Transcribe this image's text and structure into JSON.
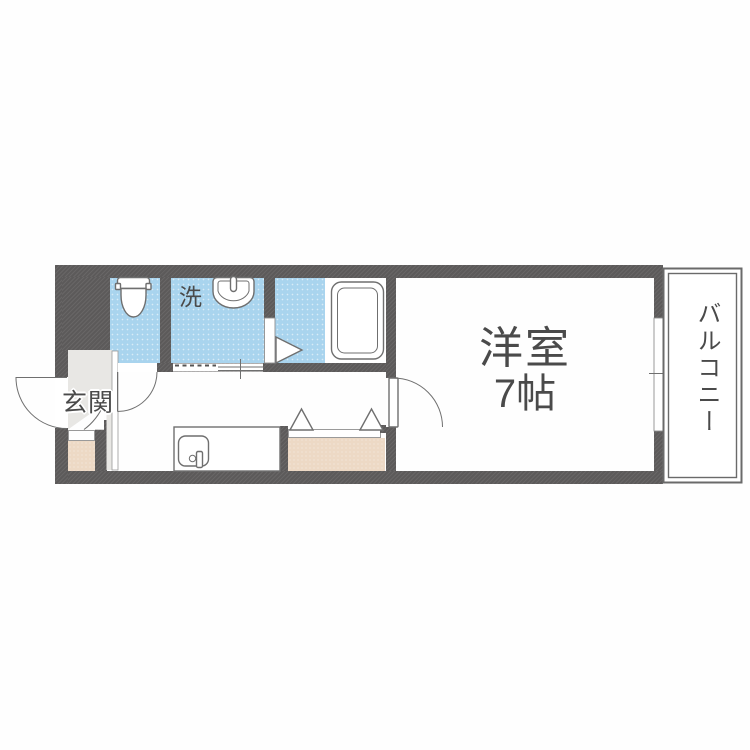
{
  "plan": {
    "type": "apartment-floor-plan",
    "labels": {
      "entrance": "玄関",
      "washer": "洗",
      "bedroom_name": "洋室",
      "bedroom_size": "7帖",
      "balcony": "バルコニー"
    },
    "colors": {
      "wall": "#5c5a5a",
      "water": "#a9d4ee",
      "storage": "#edd9c5",
      "entrance_floor": "#e8e7e4",
      "outline": "#6f6f6f",
      "text": "#4a4a4a"
    }
  }
}
